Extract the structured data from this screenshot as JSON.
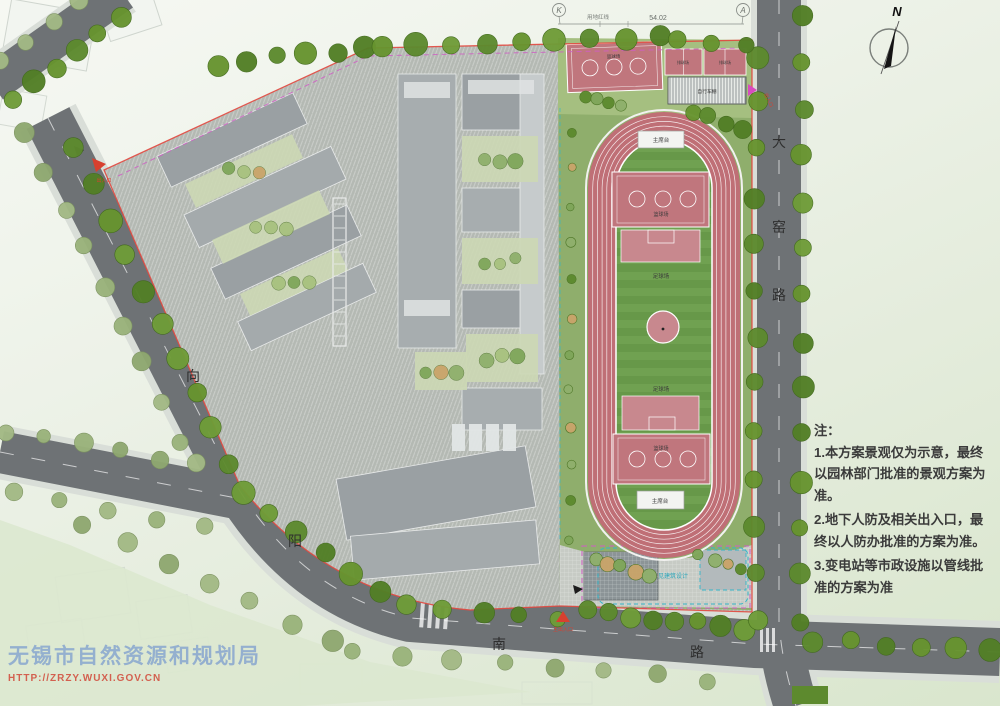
{
  "compass": {
    "label": "N"
  },
  "survey": {
    "left_marker": "K",
    "right_marker": "A",
    "dimension": "54.02",
    "redline_label": "用地红线"
  },
  "roads": {
    "east": {
      "name": "大窑路",
      "chars": [
        "大",
        "窑",
        "路"
      ]
    },
    "west": {
      "name": "向阳路",
      "chars": [
        "向",
        "阳"
      ]
    },
    "south": {
      "name": "南路",
      "chars": [
        "南",
        "路"
      ]
    }
  },
  "sports": {
    "stand_top": "主席台",
    "stand_bottom": "主席台",
    "basketball_label": "篮球场",
    "soccer_upper": "足球场",
    "soccer_lower": "足球场",
    "top_court_label": "篮球场",
    "volleyball_left": "排球场",
    "volleyball_right": "排球场",
    "bike_shed": "自行车棚",
    "design_note": "见建筑设计"
  },
  "entrances": {
    "west": "出入口",
    "south": "主出入口",
    "east": "出入口"
  },
  "notes": {
    "title": "注：",
    "items": [
      "1.本方案景观仅为示意，最终以园林部门批准的景观方案为准。",
      "2.地下人防及相关出入口，最终以人防办批准的方案为准。",
      "3.变电站等市政设施以管线批准的方案为准"
    ]
  },
  "watermark": {
    "agency": "无锡市自然资源和规划局",
    "url": "HTTP://ZRZY.WUXI.GOV.CN"
  },
  "colors": {
    "road": "#6e7275",
    "roadEdge": "#d9ded8",
    "paving": "#b4b9b3",
    "track": "#bf6f76",
    "infieldA": "#70a151",
    "infieldB": "#679849",
    "lawn": "#8fae6c",
    "lawnLight": "#a5bf80",
    "court": "#c0767d",
    "courtSoft": "#c8888e",
    "treeDark": "#5d8a2e",
    "treeLight": "#9ab37b",
    "boundaryRed": "#e2483f",
    "magenta": "#cf5ec4",
    "cyan": "#35b6c9",
    "building": "#9aa0a3",
    "entranceRed": "#d8402f",
    "noteText": "#3b3b3b"
  }
}
